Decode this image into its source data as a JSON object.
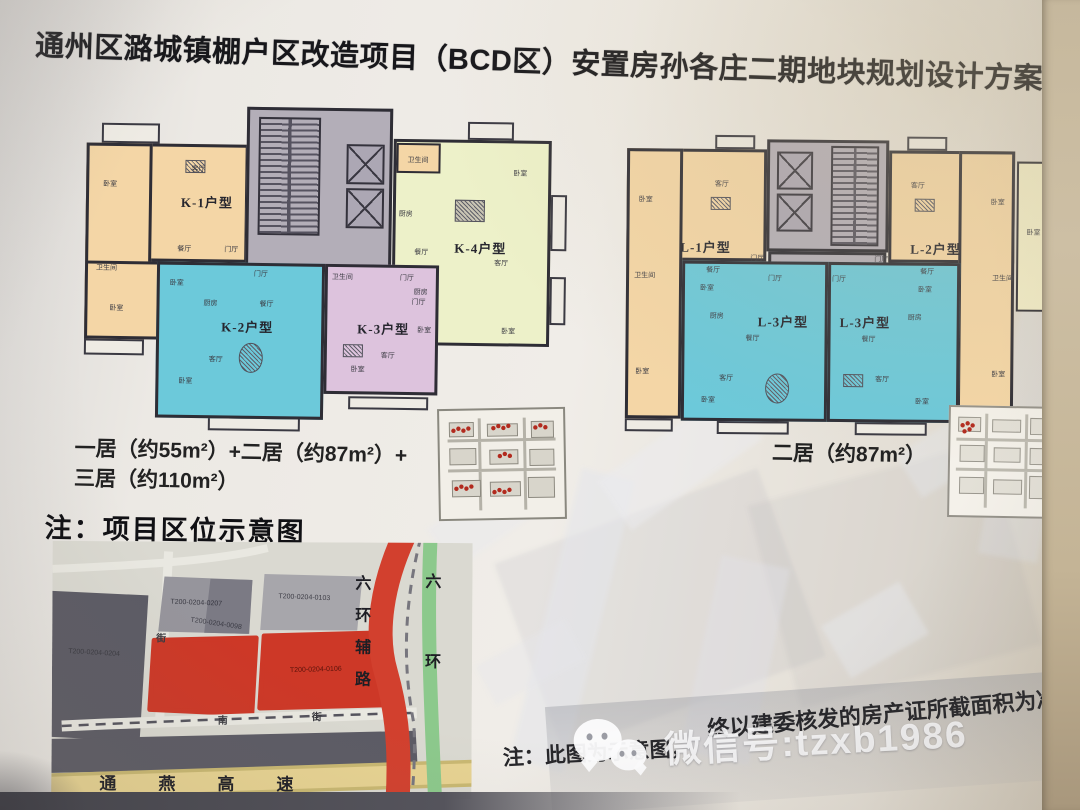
{
  "title": "通州区潞城镇棚户区改造项目（BCD区）安置房孙各庄二期地块规划设计方案",
  "labels": {
    "bedroom": "卧室",
    "living": "客厅",
    "dining": "餐厅",
    "foyer": "门厅",
    "kitchen": "厨房",
    "bath": "卫生间"
  },
  "units": {
    "k1": "K-1户型",
    "k2": "K-2户型",
    "k3": "K-3户型",
    "k4": "K-4户型",
    "l1": "L-1户型",
    "l2": "L-2户型",
    "l3": "L-3户型"
  },
  "captions": {
    "left_line1": "一居（约55m²）+二居（约87m²）+",
    "left_line2": "三居（约110m²）",
    "right": "二居（约87m²）"
  },
  "location": {
    "heading": "注：项目区位示意图",
    "parcels": [
      "T200-0204-0207",
      "T200-0204-0098",
      "T200-0204-0103",
      "T200-0204-0106",
      "T200-0204-0204"
    ],
    "roads": {
      "ring_aux": "六环辅路",
      "ring": "六环",
      "expressway": "通燕高速"
    },
    "streets": {
      "v": "街",
      "h1": "南",
      "h2": "街"
    }
  },
  "footer": {
    "note_part1": "注：此图为示意图，",
    "note_part2": "终以建委核发的房产证所截面积为准"
  },
  "watermark": {
    "icon": "wechat-icon",
    "text": "微信号:tzxb1986"
  },
  "colors": {
    "unit_peach": "#f4d6a6",
    "unit_teal": "#6cc9da",
    "unit_pink": "#ddc3dd",
    "unit_green": "#edf1c9",
    "unit_cream": "#f2edc8",
    "core_gray": "#b3aeb8",
    "wall": "#2e2d35",
    "parcel_red": "#cd3827",
    "parcel_dark": "#5c5b65",
    "road_red": "#d2402e",
    "road_green": "#8cc98c",
    "road_yellow": "#e7d392"
  }
}
